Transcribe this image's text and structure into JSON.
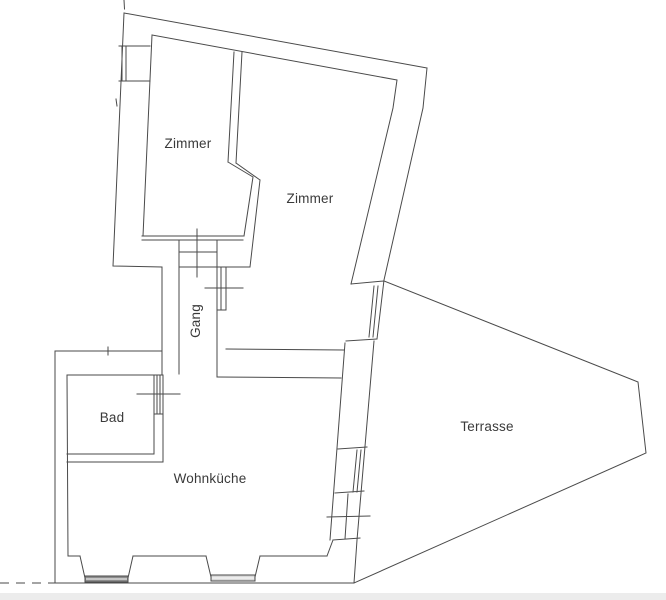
{
  "labels": {
    "zimmer_left": "Zimmer",
    "zimmer_right": "Zimmer",
    "gang": "Gang",
    "bad": "Bad",
    "wohnkueche": "Wohnküche",
    "terrasse": "Terrasse"
  },
  "colors": {
    "line": "#4a4a4a",
    "text": "#3a3a3a",
    "window_dark": "#8c8c8c",
    "window_light": "#d9d9d9",
    "band": "#ececec",
    "background": "#ffffff"
  }
}
